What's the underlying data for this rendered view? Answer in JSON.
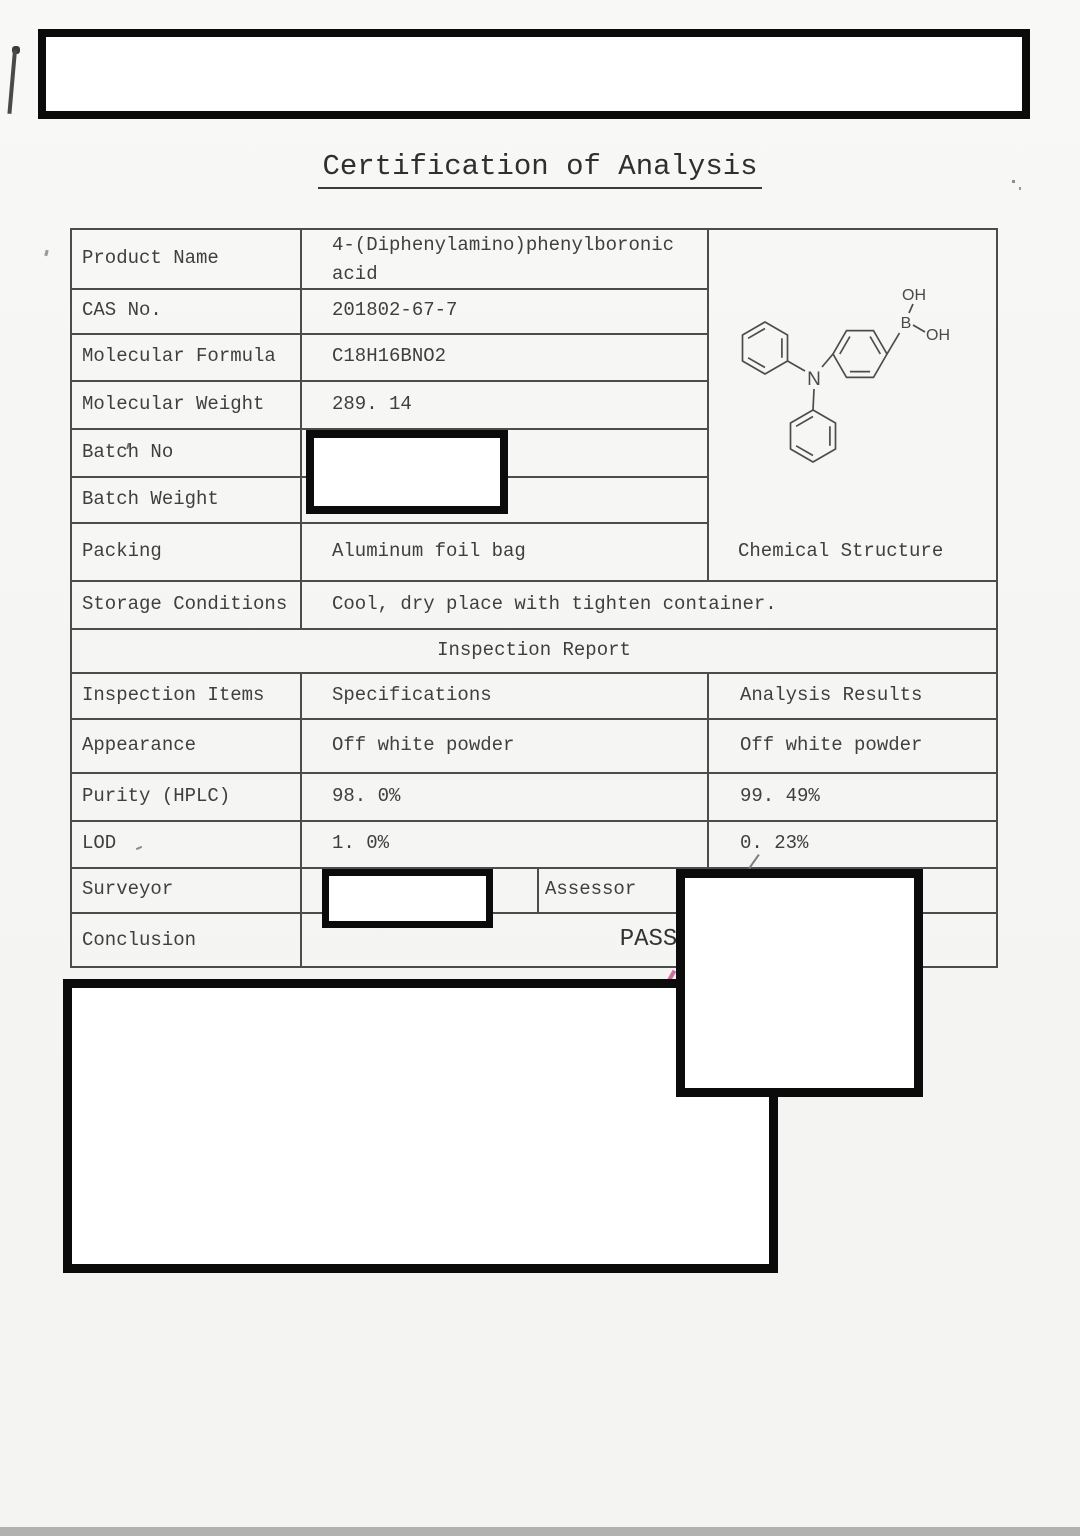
{
  "document": {
    "title": "Certification of Analysis",
    "product": {
      "label": "Product Name",
      "value": "4-(Diphenylamino)phenylboronic acid"
    },
    "cas": {
      "label": "CAS No.",
      "value": "201802-67-7"
    },
    "formula": {
      "label": "Molecular Formula",
      "value": "C18H16BNO2"
    },
    "mol_weight": {
      "label": "Molecular Weight",
      "value": "289. 14"
    },
    "batch_no": {
      "label": "Batch No"
    },
    "batch_weight": {
      "label": "Batch Weight"
    },
    "packing": {
      "label": "Packing",
      "value": "Aluminum foil bag"
    },
    "storage": {
      "label": "Storage Conditions",
      "value": "Cool, dry place with tighten container."
    },
    "structure_caption": "Chemical Structure",
    "inspection": {
      "section_title": "Inspection Report",
      "columns": {
        "items": "Inspection Items",
        "specs": "Specifications",
        "results": "Analysis Results"
      },
      "rows": [
        {
          "item": "Appearance",
          "spec": "Off white powder",
          "result": "Off white powder"
        },
        {
          "item": "Purity (HPLC)",
          "spec": "98. 0%",
          "result": "99. 49%"
        },
        {
          "item": "LOD",
          "spec": "1. 0%",
          "result": "0. 23%"
        }
      ],
      "surveyor_label": "Surveyor",
      "assessor_label": "Assessor",
      "conclusion_label": "Conclusion",
      "conclusion_result": "PASS"
    },
    "molecule": {
      "atom_oh_top": "OH",
      "atom_b": "B",
      "atom_oh_right": "OH",
      "atom_n": "N"
    }
  }
}
